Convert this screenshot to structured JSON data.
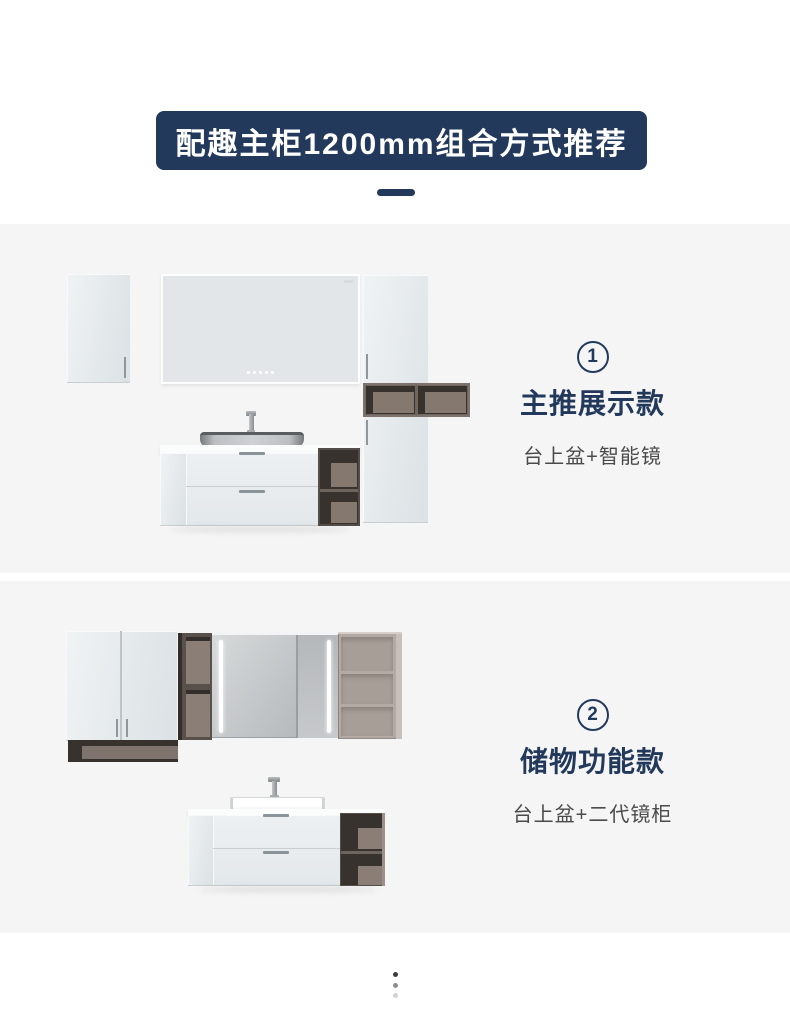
{
  "header": {
    "title": "配趣主柜1200mm组合方式推荐"
  },
  "sections": [
    {
      "number": "1",
      "title": "主推展示款",
      "subtitle": "台上盆+智能镜"
    },
    {
      "number": "2",
      "title": "储物功能款",
      "subtitle": "台上盆+二代镜柜"
    }
  ],
  "footer": {
    "dot_colors": [
      "#3c3c3c",
      "#8d8d8d",
      "#d2d2d2"
    ]
  },
  "colors": {
    "page_bg": "#ffffff",
    "navy": "#22395c",
    "sec_bg": "#f5f5f5",
    "sub_gray": "#4a4a4a",
    "dark": "#38322e",
    "taupe": "#84786f",
    "taupe_cab": "#b4aaa4",
    "mirror_face": "#e3e6e8"
  }
}
